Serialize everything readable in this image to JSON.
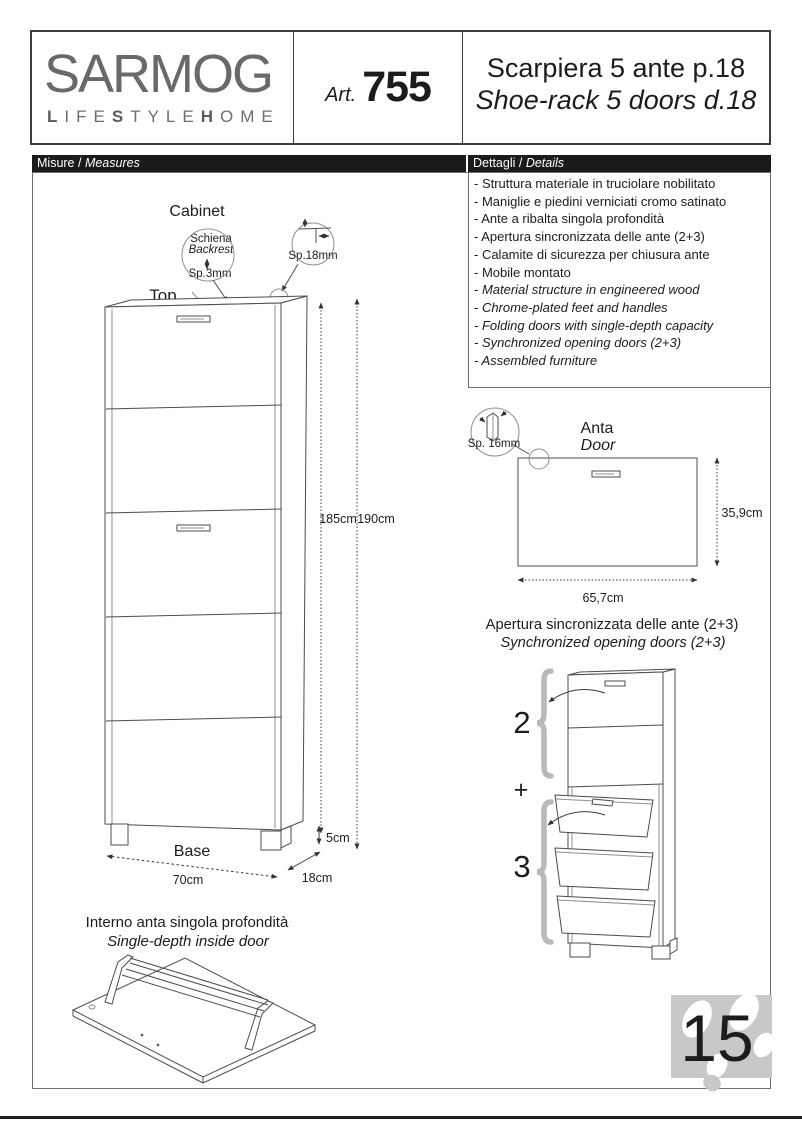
{
  "colors": {
    "bar_bg": "#1b1b1b",
    "brand_gray": "#6a686d",
    "brace_gray": "#b9b9b9",
    "stamp_gray": "#c8c8c8",
    "drawing_line": "#4c4c4c"
  },
  "header": {
    "brand": {
      "name": "SARMOG",
      "tagline_parts": [
        "L",
        "IFE",
        "S",
        "TYLE",
        "H",
        "OME"
      ]
    },
    "article": {
      "prefix": "Art.",
      "number": "755"
    },
    "title": {
      "line_it": "Scarpiera 5 ante p.18",
      "line_en": "Shoe-rack 5 doors d.18"
    }
  },
  "bars": {
    "measures_it": "Misure / ",
    "measures_en": "Measures",
    "details_it": "Dettagli / ",
    "details_en": "Details"
  },
  "details": {
    "items_it": [
      "- Struttura materiale in truciolare nobilitato",
      "- Maniglie e piedini verniciati cromo satinato",
      "- Ante a ribalta singola profondità",
      "- Apertura sincronizzata delle ante (2+3)",
      "- Calamite di sicurezza per chiusura ante",
      "- Mobile montato"
    ],
    "items_en": [
      "- Material structure in engineered wood",
      "- Chrome-plated feet and handles",
      "- Folding doors with single-depth capacity",
      "- Synchronized opening doors (2+3)",
      "- Assembled furniture"
    ]
  },
  "cabinet": {
    "title": "Cabinet",
    "top_label": "Top",
    "backrest_it": "Schiena",
    "backrest_en": "Backrest",
    "backrest_thickness": "Sp.3mm",
    "panel_thickness": "Sp.18mm",
    "height_cabinet": "185cm",
    "height_total": "190cm",
    "feet_height": "5cm",
    "base_label": "Base",
    "base_width": "70cm",
    "base_depth": "18cm"
  },
  "door": {
    "title_it": "Anta",
    "title_en": "Door",
    "thickness": "Sp. 16mm",
    "height": "35,9cm",
    "width": "65,7cm"
  },
  "sync": {
    "caption_it": "Apertura sincronizzata delle ante (2+3)",
    "caption_en": "Synchronized opening doors (2+3)",
    "group_top": "2",
    "plus": "+",
    "group_bottom": "3"
  },
  "inside_door": {
    "caption_it": "Interno anta singola profondità",
    "caption_en": "Single-depth inside door"
  },
  "footer": {
    "page_number": "15"
  }
}
